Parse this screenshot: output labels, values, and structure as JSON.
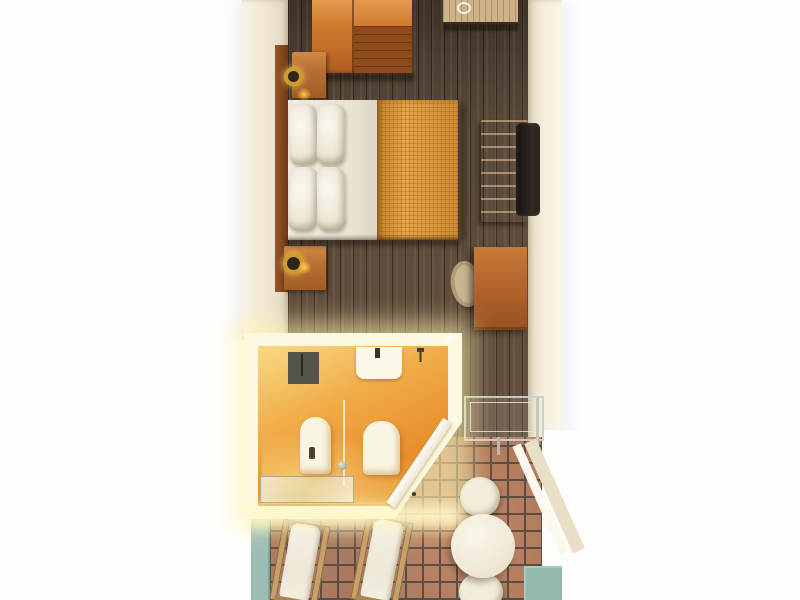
{
  "scene": {
    "title": "Hotel room floor plan (3D top-down render)",
    "view": "top-down",
    "rooms": [
      {
        "name": "bedroom",
        "floor": "dark wood planks"
      },
      {
        "name": "bathroom",
        "floor": "orange with warm glow"
      },
      {
        "name": "terrace",
        "floor": "terracotta tiles"
      }
    ],
    "furniture": {
      "wardrobe": {
        "label": "Wardrobe"
      },
      "entry_door": {
        "label": "Entry door"
      },
      "bed": {
        "label": "Double bed with pillows and orange bedspread"
      },
      "headboard": {
        "label": "Headboard panel"
      },
      "nightstand_1": {
        "label": "Nightstand with ring lamp (top)"
      },
      "nightstand_2": {
        "label": "Nightstand with ring lamp (bottom)"
      },
      "tv_console": {
        "label": "TV console"
      },
      "tv": {
        "label": "Television"
      },
      "desk": {
        "label": "Desk"
      },
      "desk_chair": {
        "label": "Desk chair"
      },
      "shower_mat": {
        "label": "Shower area"
      },
      "sink": {
        "label": "Washbasin"
      },
      "bidet": {
        "label": "Bidet"
      },
      "toilet": {
        "label": "Toilet"
      },
      "shower_glass": {
        "label": "Glass shower screen"
      },
      "bath_door": {
        "label": "Bathroom door (diagonal)"
      },
      "glass_shelf": {
        "label": "Glass shelf / luggage rack"
      },
      "lounge_1": {
        "label": "Sun lounger 1"
      },
      "lounge_2": {
        "label": "Sun lounger 2"
      },
      "patio_table": {
        "label": "Round patio table"
      },
      "patio_chair_1": {
        "label": "Patio chair (top)"
      },
      "patio_chair_2": {
        "label": "Patio chair (bottom)"
      }
    },
    "palette": {
      "background": "#fefefe",
      "wall": "#efe6d2",
      "wood_floor": "#5a4a3c",
      "wardrobe_wood": "#cf7c30",
      "bedspread": "#e19c3e",
      "linen": "#f6f2e6",
      "bathroom_orange": "#e78e2c",
      "bathroom_glow": "#fff4b0",
      "tile": "#b17a5c",
      "grout": "#5c4d44",
      "teal_accent": "#9cbdb5",
      "tv_black": "#17120f",
      "lamp_gold": "#cf9d2f"
    }
  }
}
